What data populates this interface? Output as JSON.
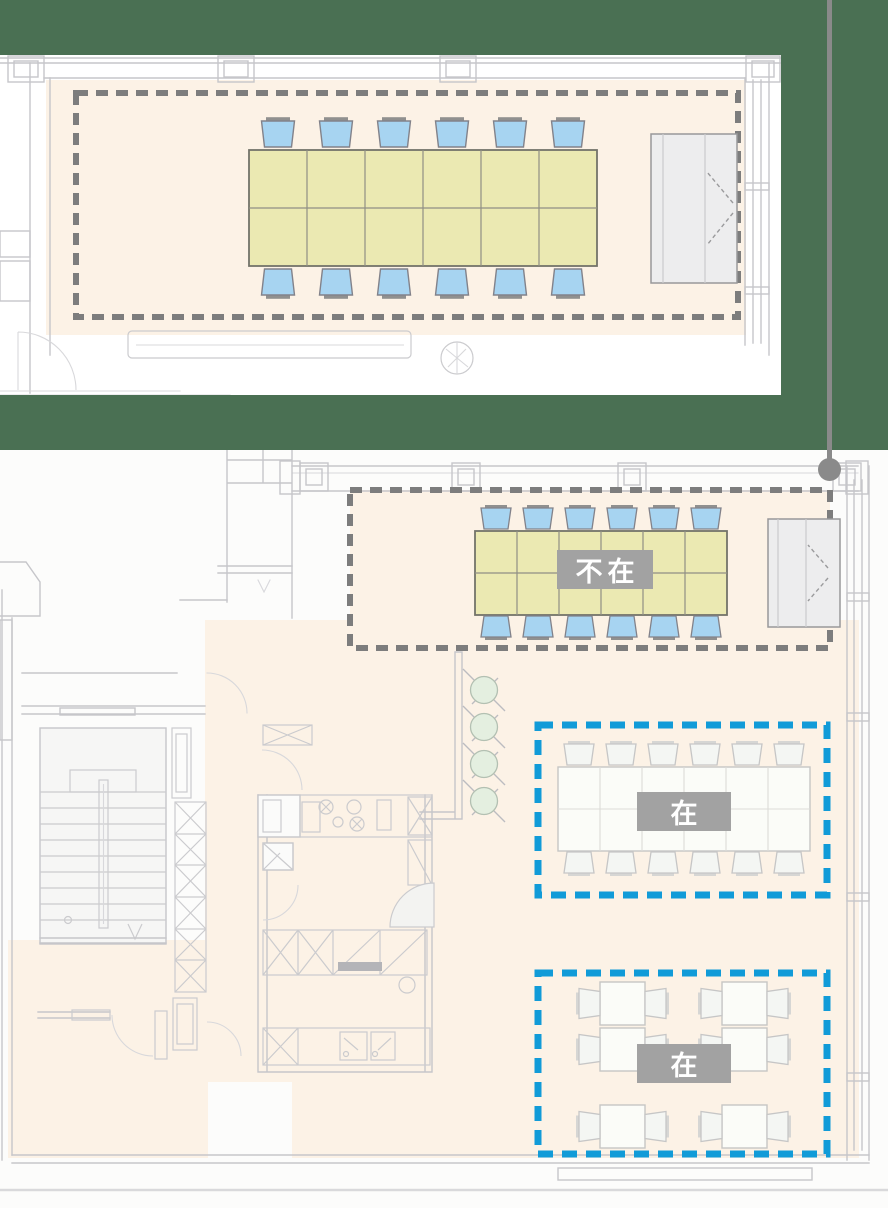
{
  "colors": {
    "canvas_green": "#4a7053",
    "plan_paper": "#ffffff",
    "room_highlight_peach": "#fcf2e6",
    "wall_gray": "#c6c6ca",
    "table_yellow": "#ebe9b2",
    "chair_blue": "#a7d4f1",
    "ghost_furniture_gray": "#f4f6f3",
    "absent_border": "#7d7d7d",
    "present_border": "#119bd8",
    "label_bg": "#a2a2a2",
    "label_text": "#ffffff",
    "connector_gray": "#8a8a8a",
    "tree_green": "#e4efe0",
    "cabinet_gray": "#ededee"
  },
  "areas": [
    {
      "id": "meeting-room",
      "status": "absent",
      "label": "不在",
      "border_color": "#7d7d7d",
      "seats": 12,
      "tables": 1
    },
    {
      "id": "long-table-area",
      "status": "present",
      "label": "在",
      "border_color": "#119bd8",
      "seats": 12,
      "tables": 1
    },
    {
      "id": "small-tables-area",
      "status": "present",
      "label": "在",
      "border_color": "#119bd8",
      "seats": 12,
      "tables": 6
    }
  ]
}
